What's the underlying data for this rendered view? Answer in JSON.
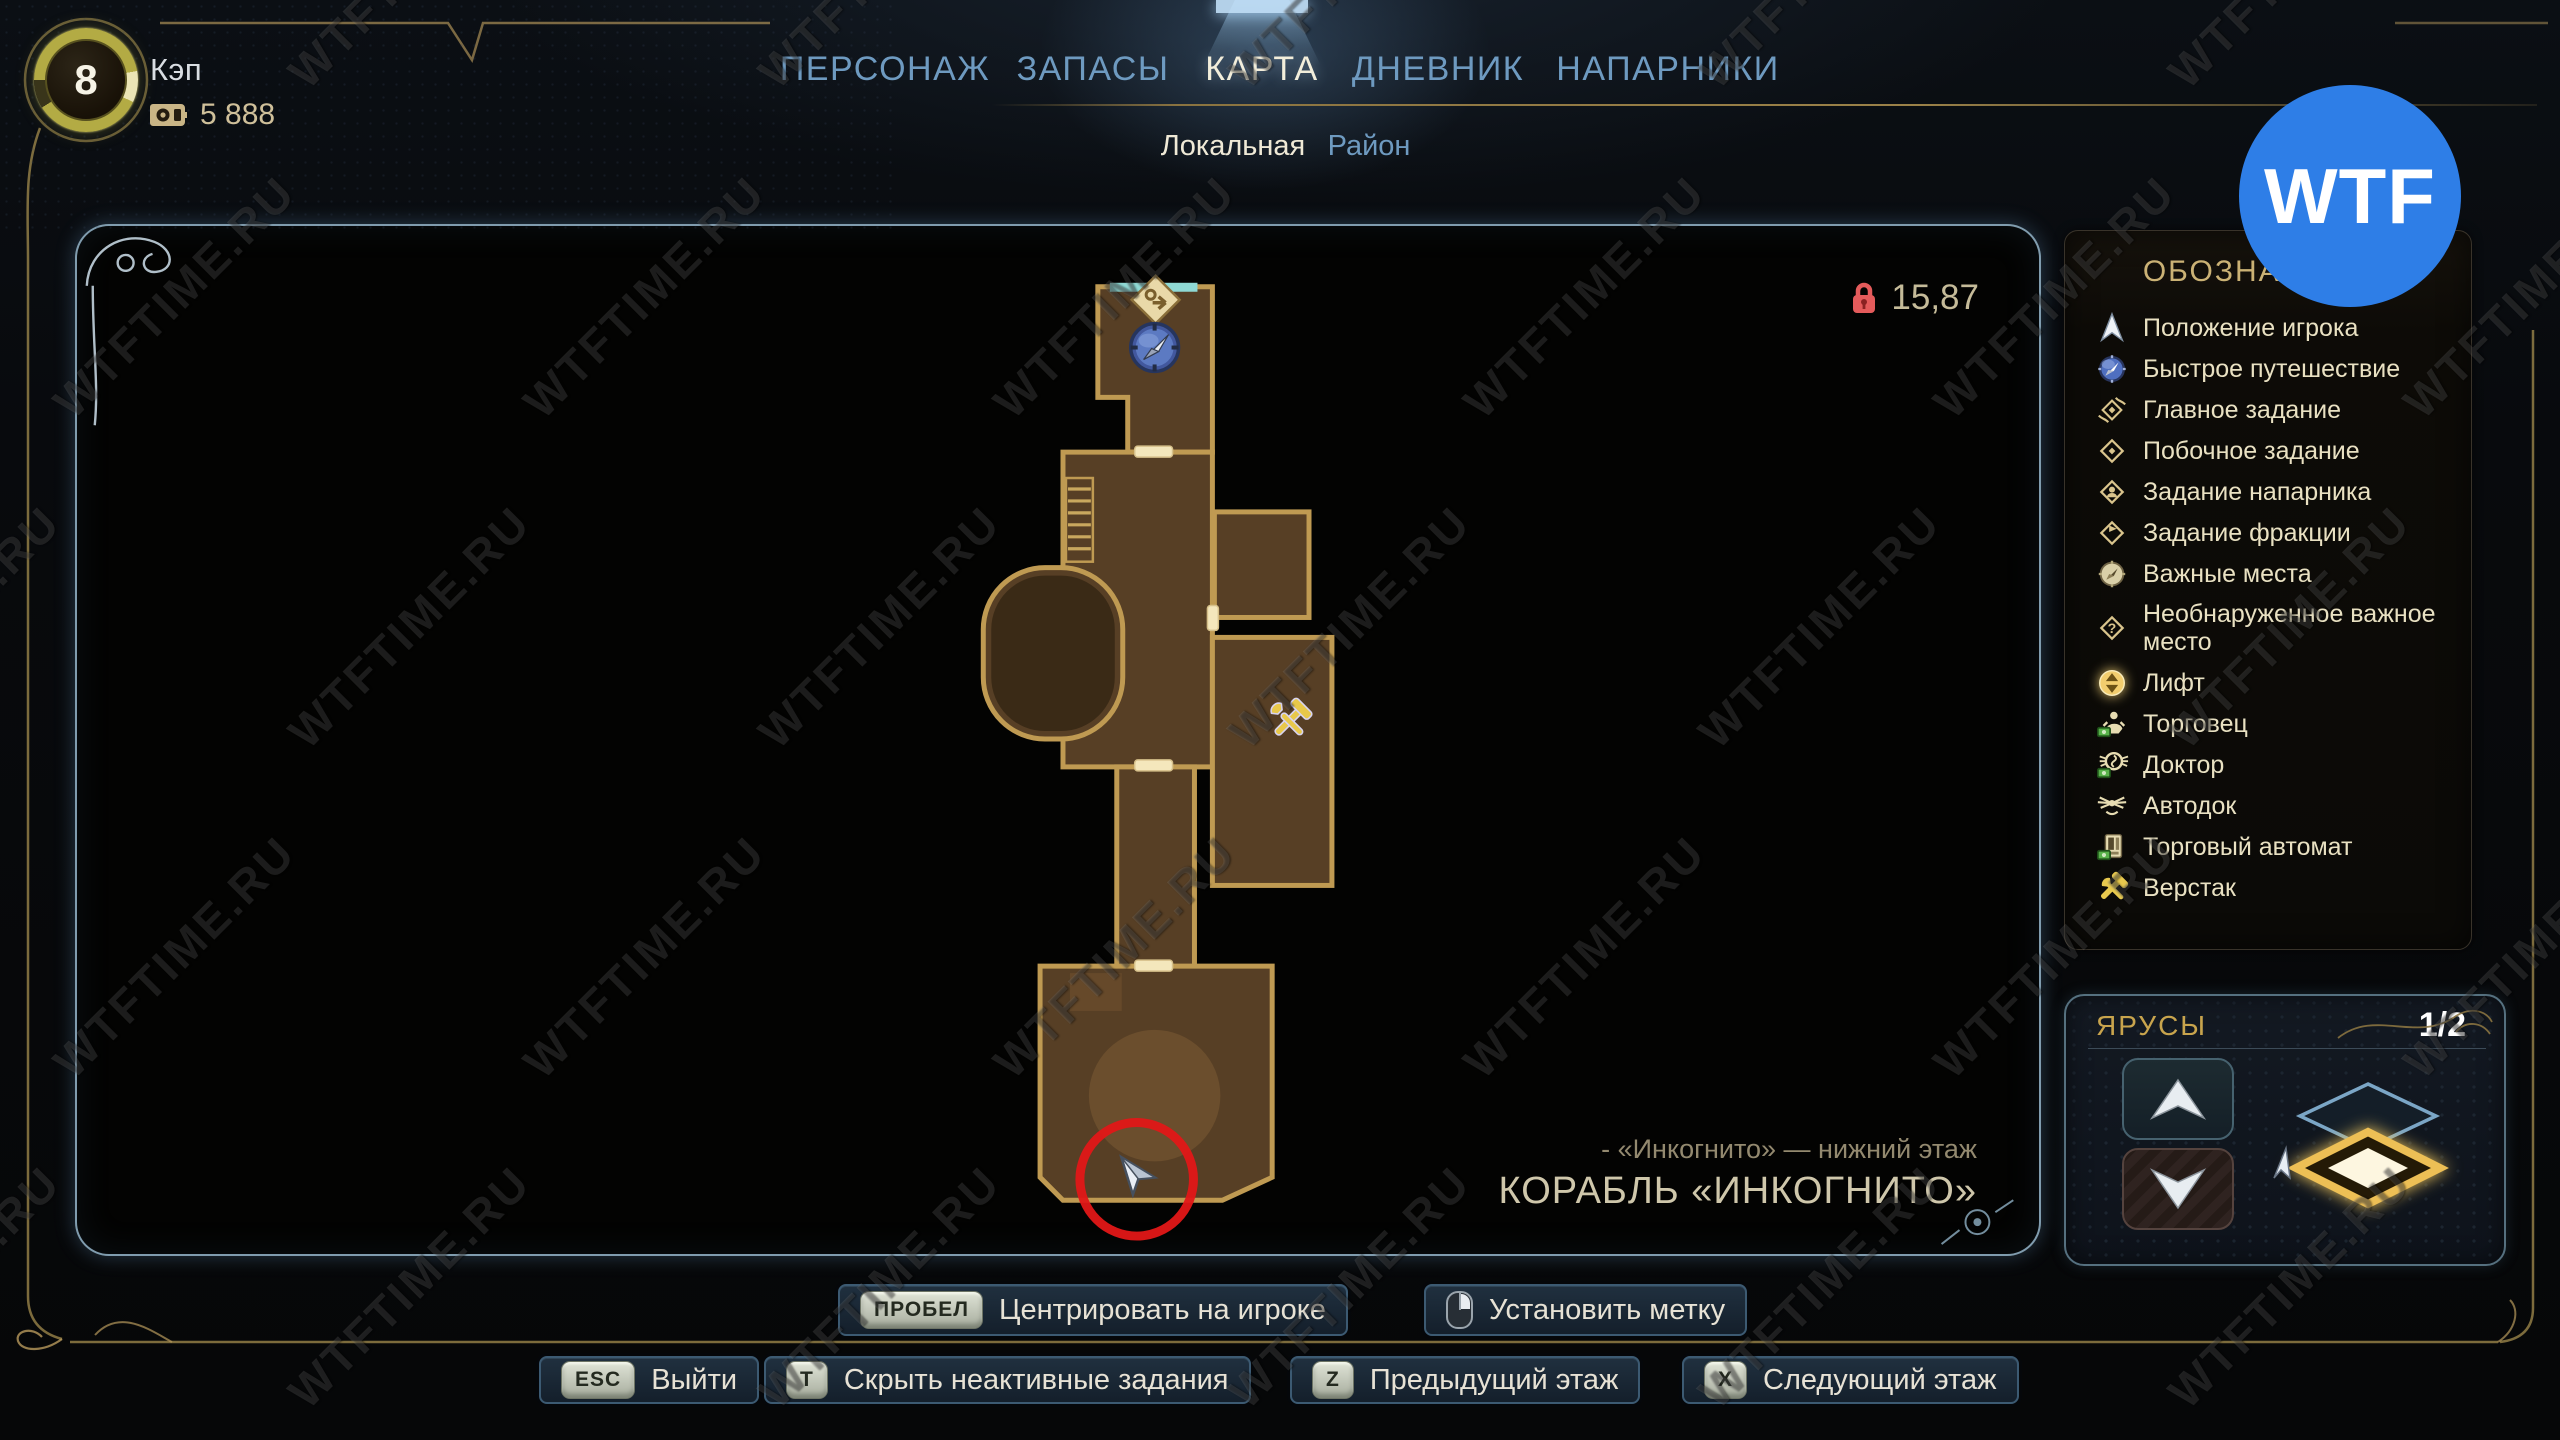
{
  "header": {
    "level": "8",
    "player_name": "Кэп",
    "currency_amount": "5 888"
  },
  "nav": {
    "tabs": [
      {
        "label": "ПЕРСОНАЖ",
        "active": false
      },
      {
        "label": "ЗАПАСЫ",
        "active": false
      },
      {
        "label": "КАРТА",
        "active": true
      },
      {
        "label": "ДНЕВНИК",
        "active": false
      },
      {
        "label": "НАПАРНИКИ",
        "active": false
      }
    ],
    "subtabs": [
      {
        "label": "Локальная",
        "active": true
      },
      {
        "label": "Район",
        "active": false
      }
    ]
  },
  "map": {
    "zoom_scale": "15,87",
    "location_sub": "- «Инкогнито» — нижний этаж",
    "location_title": "КОРАБЛЬ «ИНКОГНИТО»"
  },
  "legend": {
    "title": "ОБОЗНАЧЕНИЯ",
    "items": [
      {
        "icon": "player-position-icon",
        "label": "Положение игрока"
      },
      {
        "icon": "fast-travel-icon",
        "label": "Быстрое путешествие"
      },
      {
        "icon": "main-quest-icon",
        "label": "Главное задание"
      },
      {
        "icon": "side-quest-icon",
        "label": "Побочное задание"
      },
      {
        "icon": "companion-quest-icon",
        "label": "Задание напарника"
      },
      {
        "icon": "faction-quest-icon",
        "label": "Задание фракции"
      },
      {
        "icon": "important-place-icon",
        "label": "Важные места"
      },
      {
        "icon": "undiscovered-place-icon",
        "label": "Необнаруженное важное место"
      },
      {
        "icon": "elevator-icon",
        "label": "Лифт"
      },
      {
        "icon": "merchant-icon",
        "label": "Торговец"
      },
      {
        "icon": "doctor-icon",
        "label": "Доктор"
      },
      {
        "icon": "autodoc-icon",
        "label": "Автодок"
      },
      {
        "icon": "vending-machine-icon",
        "label": "Торговый автомат"
      },
      {
        "icon": "workbench-icon",
        "label": "Верстак"
      }
    ]
  },
  "floors": {
    "title": "ЯРУСЫ",
    "page_indicator": "1/2"
  },
  "shortcuts": {
    "row1": [
      {
        "key": "ПРОБЕЛ",
        "label": "Центрировать на игроке"
      },
      {
        "key": "mouse",
        "label": "Установить метку"
      }
    ],
    "row2": [
      {
        "key": "ESC",
        "label": "Выйти"
      },
      {
        "key": "T",
        "label": "Скрыть неактивные задания"
      },
      {
        "key": "Z",
        "label": "Предыдущий этаж"
      },
      {
        "key": "X",
        "label": "Следующий этаж"
      }
    ]
  },
  "watermark": {
    "tile_text": "WTFTIME.RU",
    "logo_text": "WTF",
    "logo_color": "#2e7ee7"
  },
  "colors": {
    "accent_gold": "#c7a558",
    "tab_blue": "#6e9ac0",
    "active_cream": "#f2ecd7",
    "map_room_brown": "#573f25",
    "map_wall_gold": "#bf9a52",
    "alert_red": "#e21717",
    "lock_red": "#e45b5b"
  }
}
